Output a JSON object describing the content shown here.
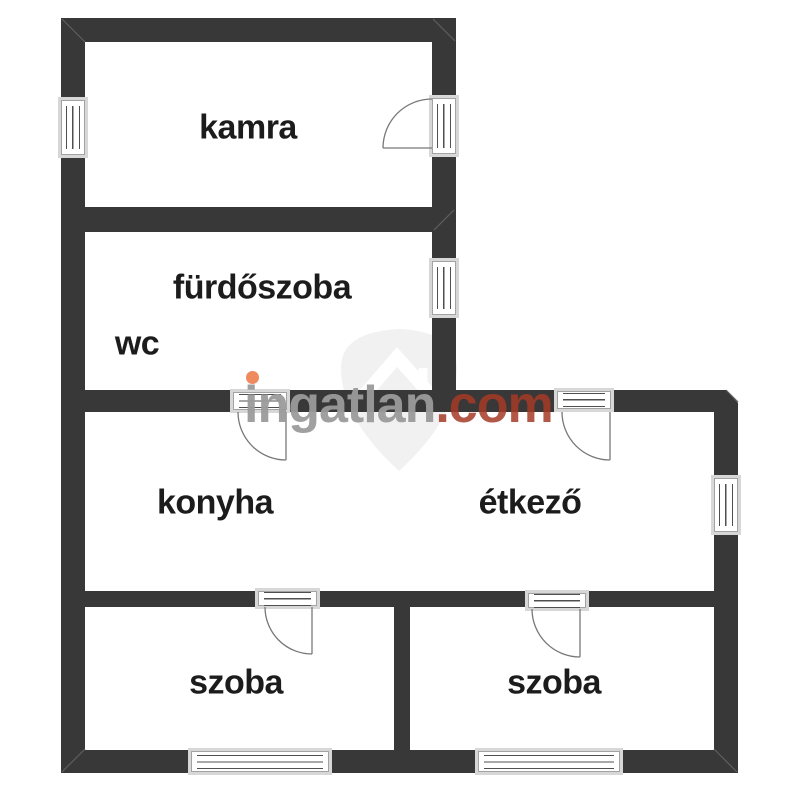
{
  "plan": {
    "rooms": {
      "kamra": {
        "label": "kamra"
      },
      "furdoszoba": {
        "label": "fürdőszoba"
      },
      "wc": {
        "label": "wc"
      },
      "konyha": {
        "label": "konyha"
      },
      "etkezo": {
        "label": "étkező"
      },
      "szoba_left": {
        "label": "szoba"
      },
      "szoba_right": {
        "label": "szoba"
      }
    }
  },
  "watermark": {
    "name_gray": "ingatlan",
    "name_red": ".com",
    "logo_icon": "ingatlan-house-shield-icon"
  },
  "colors": {
    "wall": "#383838",
    "window_frame": "#d7d7d7",
    "pane_border": "#a3a3a3",
    "glass_line": "#4f4f4f",
    "arc_line": "#787878",
    "seam_line": "#5f5f5f",
    "label_text": "#1c1c1c",
    "watermark_gray": "#9b9b9b",
    "watermark_red": "#a63a26",
    "watermark_dot": "#ef8a5e",
    "shield_fill": "#f1f1f1"
  }
}
